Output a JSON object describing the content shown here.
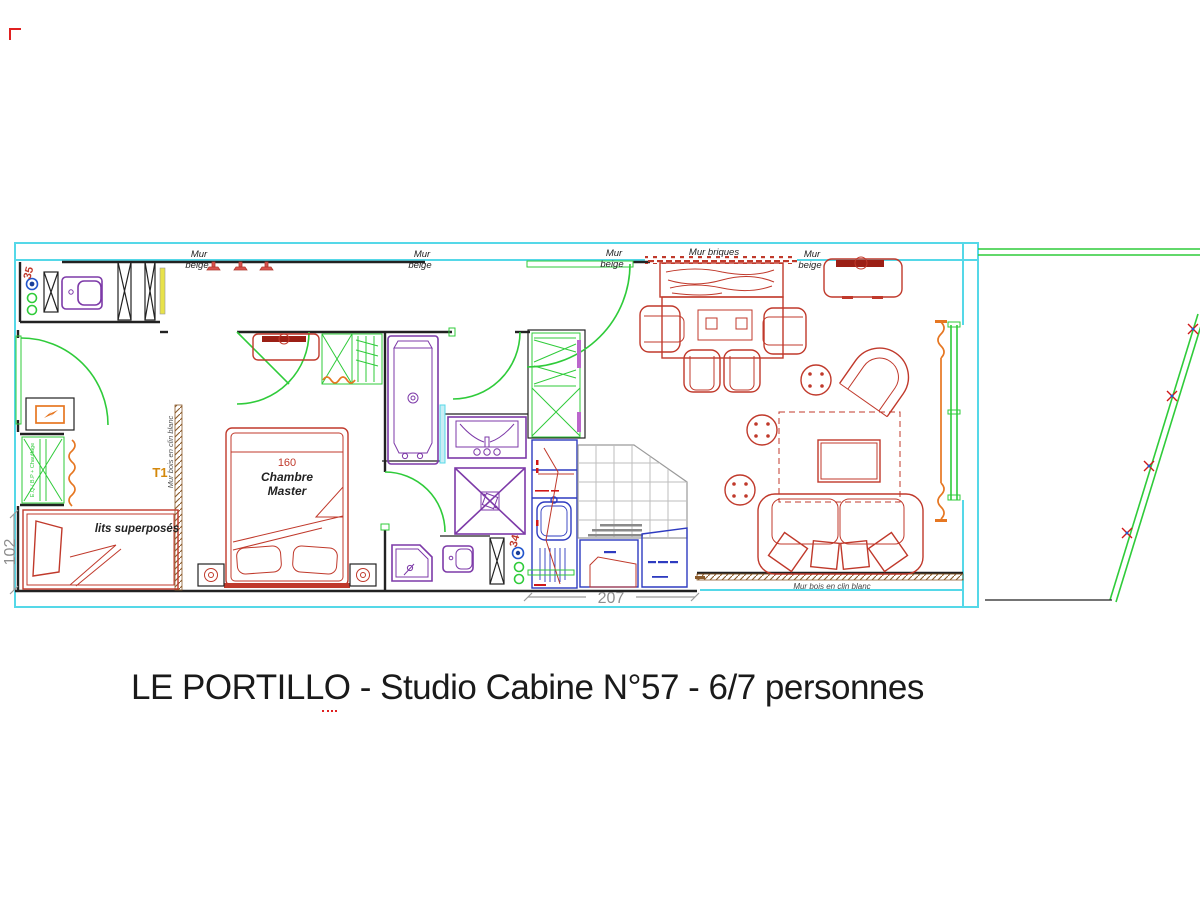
{
  "palette": {
    "cyan": "#55d8e8",
    "green": "#2fcb3a",
    "red": "#c0392b",
    "darkred": "#9b1f15",
    "purple": "#7d3aa8",
    "orange": "#e67722",
    "blue": "#2e3bc0",
    "yellow": "#e8e24a",
    "brown": "#8a5a2a",
    "gray": "#8e8e8e",
    "ink": "#1a1a1a"
  },
  "title": {
    "text": "LE PORTILLO - Studio Cabine N°57 - 6/7 personnes"
  },
  "plan": {
    "wall_labels": [
      {
        "line1": "Mur",
        "line2": "beige"
      },
      {
        "line1": "Mur",
        "line2": "beige"
      },
      {
        "line1": "Mur",
        "line2": "beige"
      },
      {
        "single": "Mur briques"
      },
      {
        "line1": "Mur",
        "line2": "beige"
      }
    ],
    "wall_notes": {
      "left": "Mur bois en clin blanc",
      "bottom": "Mur bois en clin blanc",
      "equipment": "E.Q / B.P + Chauffage"
    },
    "rooms": {
      "master": {
        "line1": "Chambre",
        "line2": "Master",
        "bed_size": "160"
      },
      "bunk_label": "lits superposés",
      "type_label": "T1"
    },
    "dimensions": {
      "bottom": "207",
      "left": "102",
      "wc": "35",
      "shower_wc": "34"
    }
  }
}
